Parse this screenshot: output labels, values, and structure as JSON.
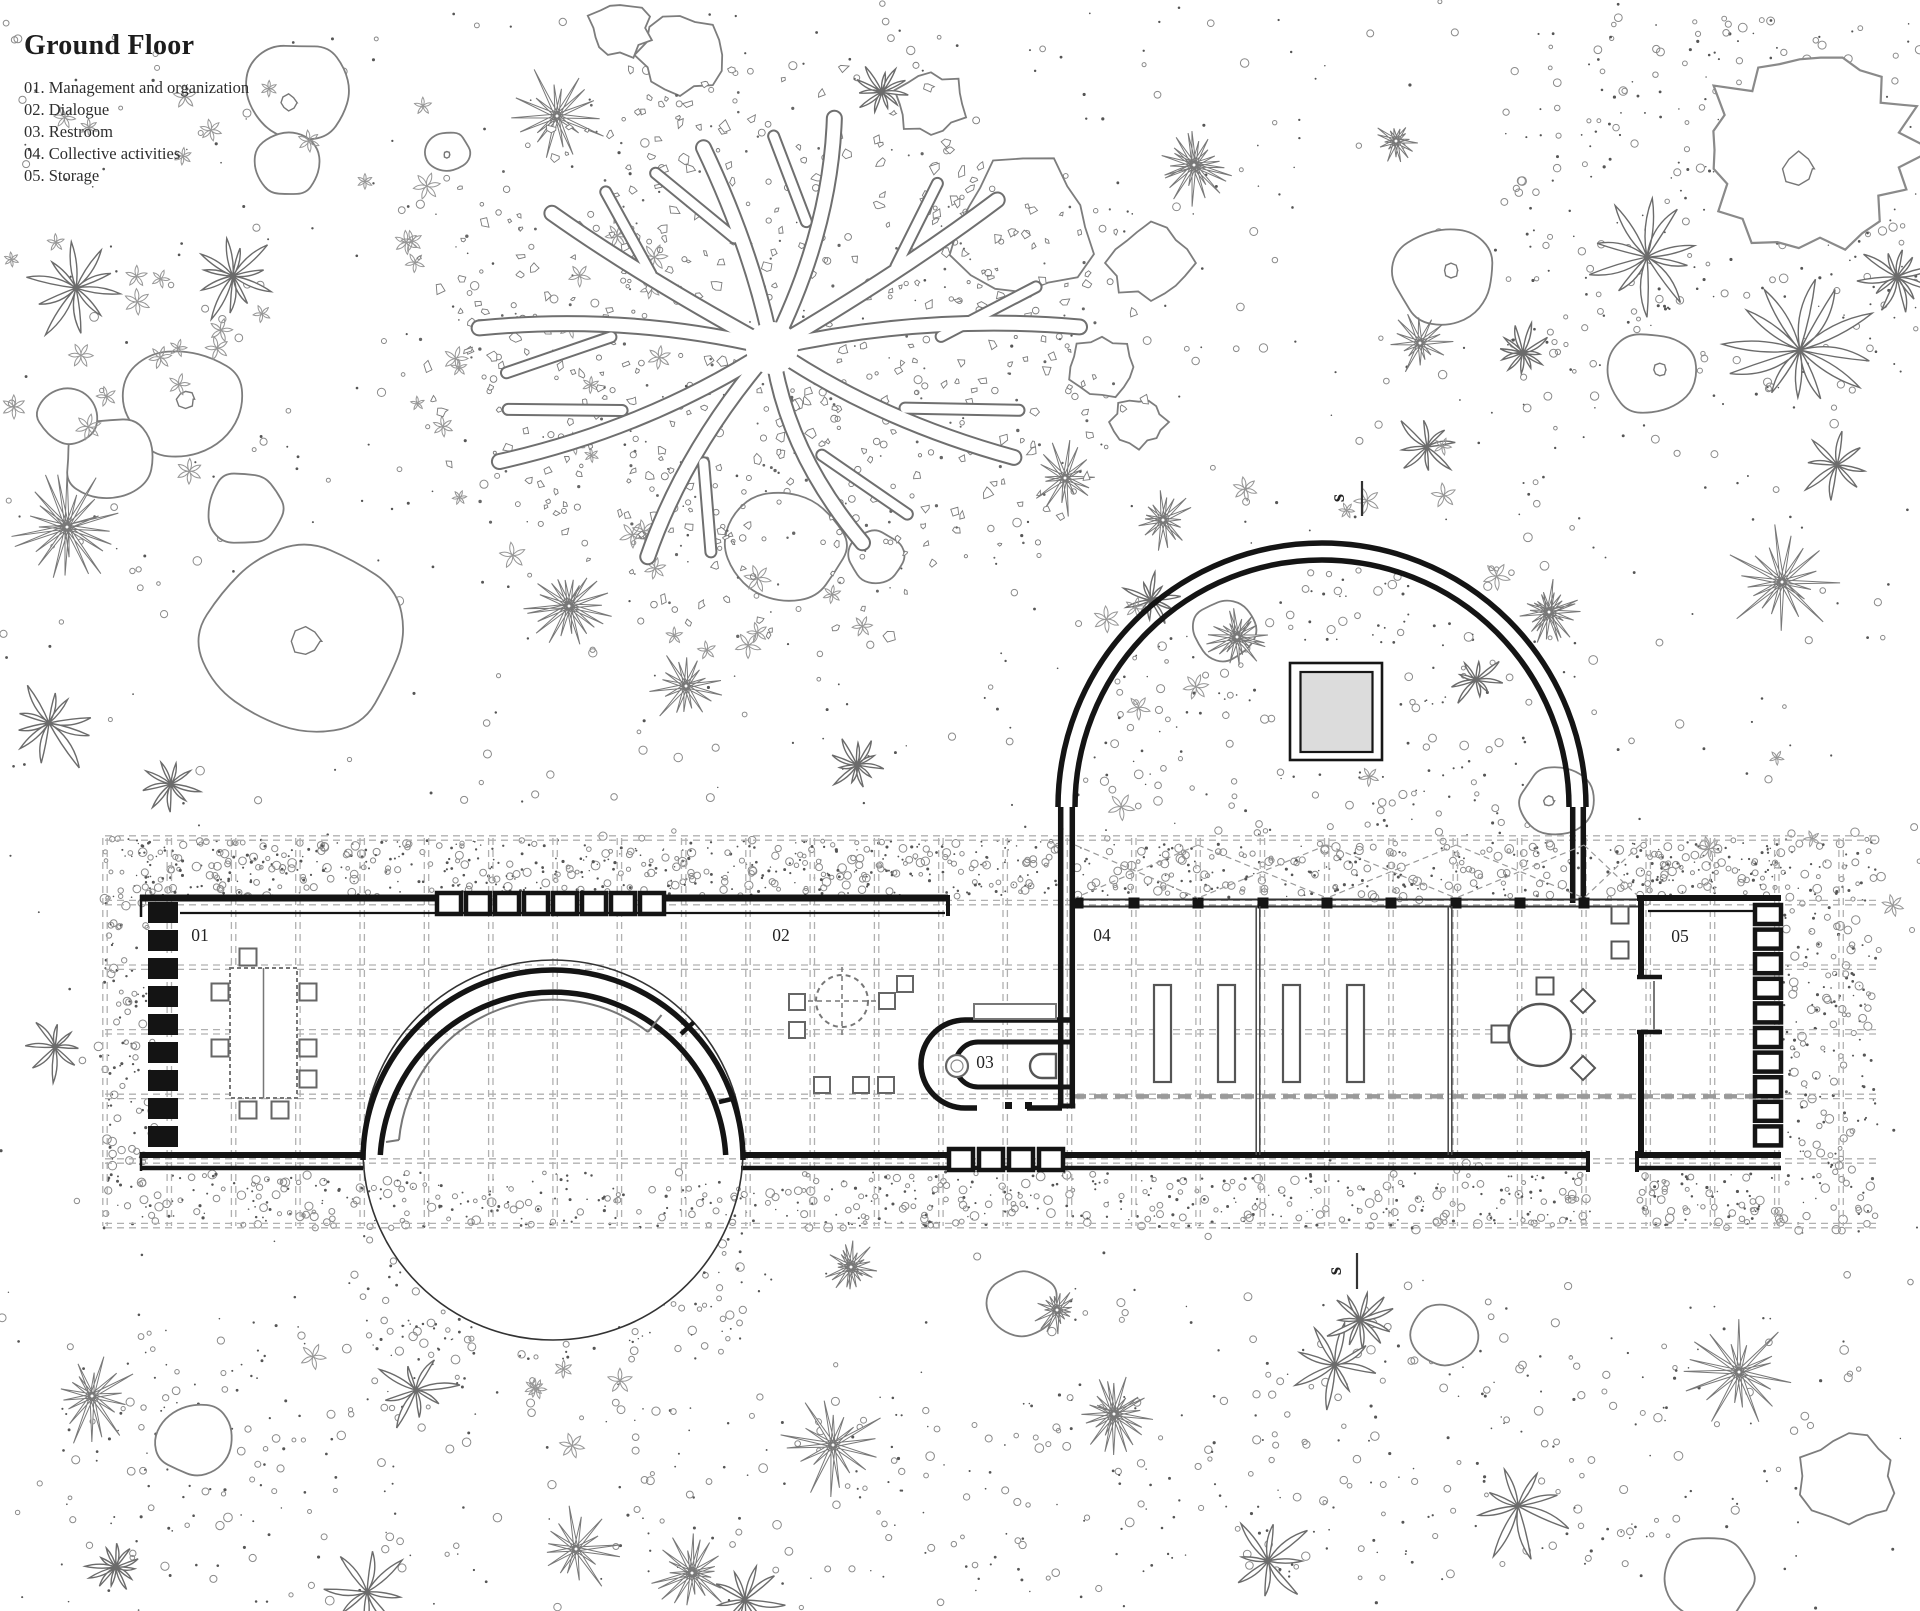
{
  "title": "Ground Floor",
  "legend": {
    "items": [
      "01. Management and organization",
      "02. Dialogue",
      "03. Restroom",
      "04. Collective activities",
      "05. Storage"
    ]
  },
  "rooms": [
    {
      "label": "01",
      "x": 200,
      "y": 941
    },
    {
      "label": "02",
      "x": 781,
      "y": 941
    },
    {
      "label": "03",
      "x": 985,
      "y": 1068
    },
    {
      "label": "04",
      "x": 1102,
      "y": 941
    },
    {
      "label": "05",
      "x": 1680,
      "y": 942
    }
  ],
  "section": {
    "letter": "s",
    "top": {
      "x": 1344,
      "y": 498,
      "tick": [
        1362,
        481,
        1362,
        516
      ]
    },
    "bottom": {
      "x": 1341,
      "y": 1271,
      "tick": [
        1357,
        1253,
        1357,
        1289
      ]
    }
  },
  "colors": {
    "ink": "#161616",
    "wall": "#141414",
    "mid_grey": "#6e6e6e",
    "soft_grey": "#8a8a8a",
    "grid_grey": "#b0b0b0",
    "section_grey": "#9a9a9a",
    "court_fill": "#dcdcdc",
    "paper": "#ffffff"
  },
  "plan": {
    "grid": {
      "x0": 105,
      "nx": 28,
      "dx": 64.3,
      "y0": 838,
      "ny": 7,
      "dy": 64.6,
      "ymax": 1226,
      "xmax": 1876,
      "heavy_y": 1096.4,
      "heavy_x": [
        1073,
        1781
      ]
    },
    "building": {
      "top_wall": {
        "y": 898,
        "inner_y": 913,
        "inner_x": [
          180,
          945
        ],
        "solid": [
          [
            140,
            437
          ],
          [
            663,
            948
          ]
        ],
        "win_band": [
          437,
          663
        ],
        "end_cap_x": 948,
        "left_edge_x": 141
      },
      "left_ladder": {
        "x": 148,
        "w": 30,
        "y0": 902,
        "rung_h": 21,
        "step": 28,
        "n": 9
      },
      "bottom_wall": {
        "y_up": 1155,
        "y_low": 1168,
        "up_segs": [
          [
            140,
            363
          ],
          [
            741,
            947
          ],
          [
            1063,
            1588
          ],
          [
            1637,
            1781
          ]
        ],
        "low_segs": [
          [
            140,
            363
          ],
          [
            741,
            1588
          ],
          [
            1637,
            1781
          ]
        ],
        "win_band": [
          949,
          1063
        ],
        "caps": [
          1588,
          1637
        ]
      },
      "circle": {
        "cx": 553,
        "cy": 1150,
        "r_out": 190,
        "r_in": 173,
        "r_rail": 155,
        "rail_a": [
          399,
          1140
        ],
        "rail_b": [
          648,
          1032
        ],
        "rail_tick": [
          661.5,
          1015
        ],
        "rungs": [
          [
            681,
            1034,
            694,
            1022
          ],
          [
            719,
            1102,
            736,
            1098
          ]
        ]
      },
      "arch": {
        "cx": 1322,
        "cy": 807,
        "r_out": 264,
        "r_in": 247,
        "left_leg_x": [
          1060.7,
          1072.3
        ],
        "left_leg_y2": 1105,
        "right_leg_x": [
          1572.7,
          1583.3
        ],
        "right_leg_y2": 903,
        "square_outer": [
          1290,
          663,
          92,
          97
        ],
        "square_inner": [
          1300.5,
          672,
          72,
          80
        ]
      },
      "colonnade": {
        "y1": 899.5,
        "y2": 906.5,
        "x0": 1075,
        "x1": 1640,
        "cols": [
          1078,
          1134,
          1198,
          1263,
          1327,
          1391,
          1456,
          1520,
          1584
        ],
        "brace_bays": [
          [
            1075,
            1198
          ],
          [
            1198,
            1327
          ],
          [
            1327,
            1456
          ],
          [
            1456,
            1584
          ],
          [
            1584,
            1640
          ]
        ],
        "brace_y": [
          845,
          898
        ]
      },
      "restroom": {
        "outer": "M1075,1020 L965,1020 A44,44 0 0 0 921,1064 A44,44 0 0 0 965,1108 L977,1108",
        "outer2": "M1027,1108 L1062,1108",
        "inner": "M1075,1042 L978,1042 A22.5,22.5 0 0 0 978,1087 L1075,1087",
        "jambs": [
          [
            1005,
            1102
          ],
          [
            1025,
            1102
          ]
        ],
        "sink": [
          957,
          1066,
          11
        ],
        "toilet": "M1056,1054 L1042,1054 A12,12 0 0 0 1042,1078 L1056,1078 Z",
        "bench": [
          974,
          1004,
          82,
          15
        ]
      },
      "room05": {
        "top": [
          1637,
          1781,
          898
        ],
        "inner_top": [
          1648,
          1755,
          911
        ],
        "left_x": 1641,
        "left_segs": [
          [
            898,
            977
          ],
          [
            1032,
            1155
          ]
        ],
        "stubs": [
          977,
          1032
        ],
        "door_x": 1654,
        "door_y": [
          981,
          1029
        ],
        "ladder": {
          "x": 1755,
          "w": 26,
          "y0": 905,
          "h": 19,
          "step": 24.6,
          "n": 10
        }
      },
      "partitions": [
        1258,
        1450
      ]
    },
    "furniture": {
      "room01": {
        "table": [
          230,
          968,
          67,
          130
        ],
        "chairs": [
          [
            248,
            957
          ],
          [
            220,
            992
          ],
          [
            220,
            1048
          ],
          [
            308,
            992
          ],
          [
            308,
            1048
          ],
          [
            308,
            1079
          ],
          [
            248,
            1110
          ],
          [
            280,
            1110
          ]
        ]
      },
      "room02": {
        "table": [
          842,
          1001,
          26
        ],
        "stools": [
          [
            797,
            1002
          ],
          [
            797,
            1030
          ],
          [
            905,
            984
          ],
          [
            887,
            1001
          ],
          [
            822,
            1085
          ],
          [
            861,
            1085
          ],
          [
            886,
            1085
          ]
        ]
      },
      "room04": {
        "benches": [
          [
            1154,
            985
          ],
          [
            1218,
            985
          ],
          [
            1283,
            985
          ],
          [
            1347,
            985
          ]
        ],
        "bench_wh": [
          17,
          97
        ],
        "table": [
          1540,
          1035,
          31
        ],
        "sq_chairs": [
          [
            1500,
            1034
          ],
          [
            1545,
            986
          ],
          [
            1620,
            915
          ],
          [
            1620,
            950
          ]
        ],
        "dia_chairs": [
          [
            1583,
            1001
          ],
          [
            1583,
            1068
          ]
        ]
      }
    },
    "palms_xyr": [
      [
        76,
        288,
        60
      ],
      [
        233,
        276,
        50
      ],
      [
        1647,
        257,
        70
      ],
      [
        1800,
        350,
        80
      ],
      [
        1523,
        353,
        30
      ],
      [
        1897,
        277,
        42
      ],
      [
        49,
        723,
        52
      ],
      [
        171,
        784,
        36
      ],
      [
        857,
        765,
        30
      ],
      [
        1837,
        465,
        42
      ],
      [
        55,
        1047,
        36
      ],
      [
        416,
        1390,
        44
      ],
      [
        1335,
        1365,
        48
      ],
      [
        1518,
        1506,
        56
      ],
      [
        882,
        92,
        30
      ],
      [
        1427,
        447,
        36
      ],
      [
        1151,
        600,
        30
      ],
      [
        1476,
        680,
        30
      ],
      [
        1268,
        1561,
        48
      ],
      [
        367,
        1592,
        52
      ],
      [
        1360,
        1320,
        38
      ],
      [
        116,
        1567,
        30
      ],
      [
        745,
        1600,
        40
      ]
    ],
    "spikys_xyr": [
      [
        557,
        116,
        52
      ],
      [
        1194,
        165,
        42
      ],
      [
        1396,
        141,
        24
      ],
      [
        67,
        527,
        58
      ],
      [
        569,
        606,
        46
      ],
      [
        686,
        686,
        40
      ],
      [
        1065,
        478,
        40
      ],
      [
        1782,
        582,
        62
      ],
      [
        92,
        1396,
        52
      ],
      [
        576,
        1549,
        46
      ],
      [
        833,
        1445,
        55
      ],
      [
        1114,
        1414,
        42
      ],
      [
        1739,
        1372,
        58
      ],
      [
        1420,
        343,
        34
      ],
      [
        1237,
        637,
        34
      ],
      [
        1163,
        520,
        32
      ],
      [
        1549,
        612,
        34
      ],
      [
        692,
        1573,
        42
      ],
      [
        1057,
        1310,
        26
      ],
      [
        851,
        1267,
        28
      ]
    ],
    "rocks_xyrds": [
      [
        300,
        92,
        55,
        1,
        0
      ],
      [
        288,
        165,
        34,
        0,
        0
      ],
      [
        448,
        152,
        22,
        1,
        0
      ],
      [
        184,
        404,
        62,
        1,
        0
      ],
      [
        110,
        459,
        46,
        0,
        0
      ],
      [
        67,
        416,
        30,
        0,
        0
      ],
      [
        245,
        508,
        40,
        0,
        0
      ],
      [
        306,
        637,
        105,
        1,
        0
      ],
      [
        784,
        545,
        62,
        0,
        0
      ],
      [
        876,
        557,
        28,
        0,
        0
      ],
      [
        1023,
        227,
        70,
        0,
        1
      ],
      [
        1151,
        263,
        40,
        0,
        1
      ],
      [
        1102,
        367,
        32,
        0,
        1
      ],
      [
        1139,
        422,
        26,
        0,
        1
      ],
      [
        1445,
        276,
        52,
        1,
        0
      ],
      [
        1558,
        800,
        38,
        1,
        0
      ],
      [
        1225,
        630,
        33,
        0,
        0
      ],
      [
        1810,
        150,
        112,
        1,
        2
      ],
      [
        1653,
        373,
        45,
        1,
        0
      ],
      [
        1023,
        1304,
        36,
        0,
        0
      ],
      [
        1445,
        1335,
        34,
        0,
        0
      ],
      [
        196,
        1440,
        40,
        0,
        0
      ],
      [
        1708,
        1580,
        46,
        0,
        0
      ],
      [
        1849,
        1476,
        46,
        0,
        1
      ],
      [
        680,
        55,
        40,
        0,
        1
      ],
      [
        931,
        104,
        34,
        0,
        1
      ],
      [
        620,
        28,
        30,
        0,
        1
      ]
    ],
    "flower_zones": [
      [
        0,
        60,
        420,
        360,
        14
      ],
      [
        400,
        100,
        260,
        480,
        22
      ],
      [
        620,
        560,
        300,
        110,
        8
      ],
      [
        1080,
        430,
        500,
        380,
        12
      ],
      [
        250,
        1350,
        520,
        200,
        6
      ],
      [
        1700,
        700,
        200,
        220,
        4
      ],
      [
        30,
        180,
        260,
        300,
        10
      ]
    ],
    "stipple_zones": [
      {
        "r": [
          0,
          0,
          1920,
          1611
        ],
        "n": 1100,
        "mode": "global"
      },
      {
        "r": [
          140,
          840,
          918,
          57
        ],
        "n": 560
      },
      {
        "r": [
          1075,
          843,
          565,
          55
        ],
        "n": 200
      },
      {
        "r": [
          1640,
          840,
          141,
          57
        ],
        "n": 120
      },
      {
        "r": [
          140,
          1172,
          1448,
          56
        ],
        "n": 560
      },
      {
        "r": [
          1637,
          1172,
          144,
          56
        ],
        "n": 70
      },
      {
        "r": [
          1783,
          838,
          93,
          395
        ],
        "n": 230
      },
      {
        "r": [
          104,
          838,
          52,
          395
        ],
        "n": 140
      },
      {
        "r": [
          363,
          1230,
          380,
          130
        ],
        "n": 220,
        "mode": "circle_halo"
      },
      {
        "r": [
          1085,
          565,
          470,
          330
        ],
        "n": 280,
        "mode": "arch"
      },
      {
        "r": [
          1500,
          15,
          420,
          400
        ],
        "n": 280
      },
      {
        "r": [
          600,
          1380,
          700,
          200
        ],
        "n": 150
      },
      {
        "r": [
          60,
          1320,
          420,
          260
        ],
        "n": 140
      },
      {
        "r": [
          1250,
          1300,
          600,
          280
        ],
        "n": 160
      }
    ],
    "tree": {
      "cx": 772,
      "cy": 348,
      "rx": 300,
      "ry": 235,
      "specks": 560,
      "halo": 140,
      "branches": [
        [
          -78,
          1.02
        ],
        [
          -40,
          1.0
        ],
        [
          -5,
          1.05
        ],
        [
          30,
          0.95
        ],
        [
          70,
          0.9
        ],
        [
          115,
          1.0
        ],
        [
          152,
          1.05
        ],
        [
          185,
          1.0
        ],
        [
          218,
          0.95
        ],
        [
          255,
          0.9
        ]
      ]
    }
  }
}
